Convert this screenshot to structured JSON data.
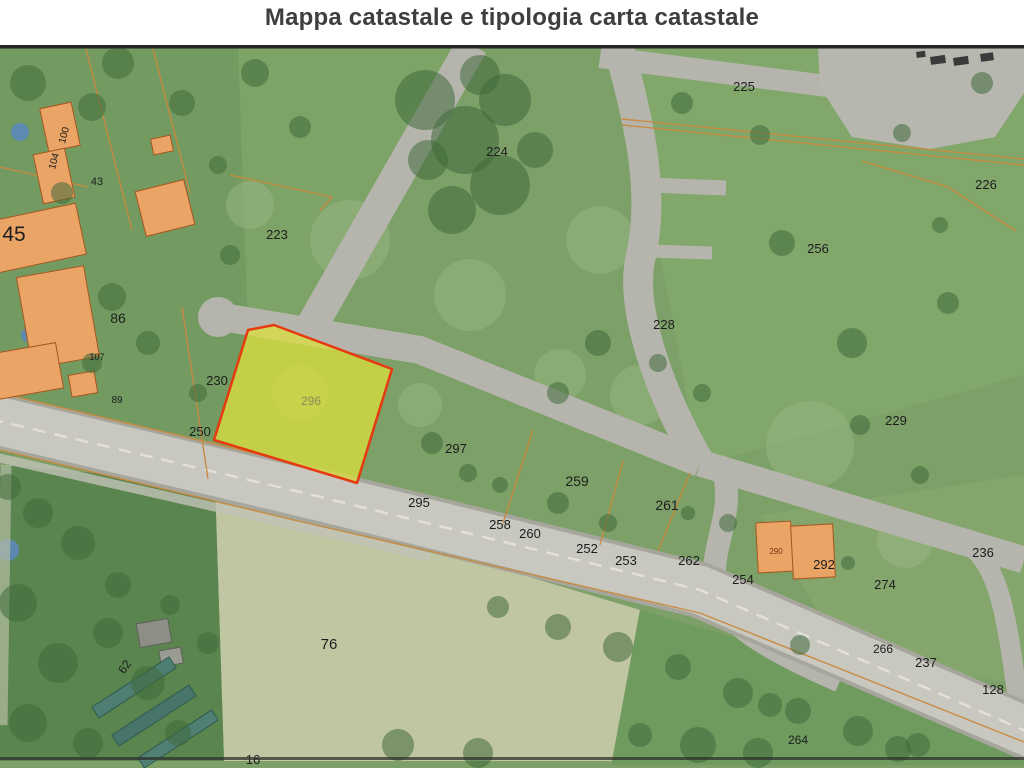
{
  "title": "Mappa catastale e tipologia carta catastale",
  "map": {
    "description": "aerial-cadastral-photo",
    "highlight": {
      "parcel_number": "296",
      "points": "248,285 274,280 392,324 357,438 214,395",
      "fill": "#dfe03a",
      "fill_opacity": 0.72,
      "stroke": "#e63a10",
      "stroke_width": 2.5
    },
    "colors": {
      "base": "#7ca067",
      "road": "#b5b5ad",
      "road_edge": "#a6a69c",
      "road_main": "#c8c8c0",
      "center_line": "#e2e0d8",
      "tree": "#3f693b",
      "patch": "#9db988",
      "blue": "#5c88bb",
      "boundary": "#c8893d",
      "building_fill": "#e9a466",
      "building_stroke": "#a8561e",
      "plaza": "#b7b7af",
      "car": "#3a3a3a",
      "label": "#1d1d1d",
      "border": "#252525"
    },
    "regions": [
      {
        "p": "0,0 238,0 248,285 214,395 0,412",
        "f": "#739b61",
        "o": 1
      },
      {
        "p": "238,0 472,0 310,284 248,285",
        "f": "#7ea468",
        "o": 0.7
      },
      {
        "p": "620,0 1024,0 1024,330 700,420",
        "f": "#82a76b",
        "o": 0.9
      },
      {
        "p": "760,470 1024,430 1024,640 845,612",
        "f": "#8cab74",
        "o": 0.5
      },
      {
        "p": "215,438 640,565 612,716 224,716",
        "f": "#c0c5a2",
        "o": 1
      },
      {
        "p": "0,420 215,438 224,716 0,716",
        "f": "#5a854e",
        "o": 1
      },
      {
        "p": "612,716 640,565 900,640 1024,690 1024,720 612,720",
        "f": "#6f9b5f",
        "o": 1
      }
    ],
    "patches": [
      [
        350,
        195,
        40
      ],
      [
        600,
        195,
        34
      ],
      [
        810,
        400,
        44
      ],
      [
        300,
        348,
        28
      ],
      [
        640,
        350,
        30
      ],
      [
        905,
        495,
        28
      ],
      [
        470,
        250,
        36
      ],
      [
        250,
        160,
        24
      ],
      [
        560,
        330,
        26
      ],
      [
        420,
        360,
        22
      ]
    ],
    "plaza": {
      "p": "818,0 1024,0 1024,48 995,92 930,104 852,92 820,42"
    },
    "culdesac": {
      "cx": 218,
      "cy": 272,
      "r": 20
    },
    "roads": [
      {
        "d": "M 600,12 L 835,42",
        "w": 22
      },
      {
        "d": "M 618,0 C 640,80 656,150 640,215 C 630,268 662,352 700,418",
        "w": 30
      },
      {
        "d": "M 648,140 L 726,143",
        "w": 15
      },
      {
        "d": "M 650,206 L 712,208",
        "w": 13
      },
      {
        "d": "M 472,0 L 310,284",
        "w": 32
      },
      {
        "d": "M 222,272 L 420,305 L 700,418",
        "w": 28
      },
      {
        "d": "M 700,418 L 1024,515",
        "w": 27
      },
      {
        "d": "M 968,498 C 1000,524 1006,568 1018,655",
        "w": 20
      },
      {
        "d": "M 722,420 C 737,468 710,498 715,540 C 720,576 762,602 840,636",
        "w": 23
      },
      {
        "d": "M -5,412 L 250,470 L 430,512",
        "w": 9,
        "c": "#c2c2b8",
        "o": 0.8
      },
      {
        "d": "M 6,420 L 2,680",
        "w": 11,
        "c": "#b5bda5",
        "o": 0.7
      },
      {
        "d": "M -10,374 L 300,447 L 700,545 L 1035,690",
        "w": 56,
        "c": "#a6a69c"
      },
      {
        "d": "M -10,374 L 300,447 L 700,545 L 1035,690",
        "w": 48,
        "c": "#c8c8c0"
      },
      {
        "d": "M -10,374 L 300,447 L 700,545 L 1035,690",
        "w": 2.5,
        "c": "#e2e0d8",
        "dash": "13 9"
      }
    ],
    "boundaries": [
      "M 622,74 L 1024,114",
      "M 622,80 L 1024,120",
      "M 862,116 L 948,142 L 1016,186",
      "M 230,130 L 332,152 L 320,166",
      "M 533,385 L 503,478",
      "M 623,416 L 600,500",
      "M 690,428 L 658,506",
      "M 182,262 L 208,434",
      "M 85,0 L 132,185",
      "M 152,0 L 190,148",
      "M 0,122 L 88,142",
      "M 0,348 L 295,418",
      "M 0,405 L 298,476 L 700,568 L 1024,697"
    ],
    "buildings": [
      [
        -18,
        168,
        100,
        52,
        -12
      ],
      [
        24,
        226,
        68,
        92,
        -10
      ],
      [
        -6,
        303,
        66,
        46,
        -10
      ],
      [
        70,
        328,
        26,
        22,
        -10
      ],
      [
        44,
        60,
        32,
        44,
        -12
      ],
      [
        38,
        106,
        32,
        50,
        -12
      ],
      [
        140,
        140,
        50,
        46,
        -14
      ],
      [
        152,
        92,
        20,
        16,
        -12
      ],
      [
        757,
        477,
        35,
        50,
        -3
      ],
      [
        792,
        480,
        42,
        53,
        -3
      ],
      [
        138,
        576,
        32,
        24,
        -10,
        "#8d8e86",
        "#5e5f58"
      ],
      [
        160,
        604,
        22,
        16,
        -10,
        "#9a9b93",
        "#5e5f58"
      ],
      [
        88,
        636,
        92,
        13,
        -33,
        "#4e7e72",
        "#2f5a50"
      ],
      [
        108,
        664,
        92,
        13,
        -33,
        "#47756a",
        "#2f5a50"
      ],
      [
        134,
        688,
        88,
        12,
        -33,
        "#508074",
        "#2f5a50"
      ]
    ],
    "blue": [
      [
        20,
        87,
        9
      ],
      [
        28,
        290,
        7
      ],
      [
        8,
        505,
        11
      ]
    ],
    "cars": [
      [
        930,
        12,
        15,
        8
      ],
      [
        953,
        13,
        15,
        8
      ],
      [
        980,
        9,
        13,
        8
      ],
      [
        916,
        7,
        9,
        6
      ]
    ],
    "trees": [
      [
        425,
        55,
        30
      ],
      [
        465,
        95,
        34
      ],
      [
        505,
        55,
        26
      ],
      [
        500,
        140,
        30
      ],
      [
        452,
        165,
        24
      ],
      [
        428,
        115,
        20
      ],
      [
        535,
        105,
        18
      ],
      [
        480,
        30,
        20
      ],
      [
        255,
        28,
        14
      ],
      [
        300,
        82,
        11
      ],
      [
        118,
        18,
        16
      ],
      [
        182,
        58,
        13
      ],
      [
        92,
        62,
        14
      ],
      [
        28,
        38,
        18
      ],
      [
        62,
        148,
        11
      ],
      [
        218,
        120,
        9
      ],
      [
        112,
        252,
        14
      ],
      [
        148,
        298,
        12
      ],
      [
        92,
        318,
        10
      ],
      [
        198,
        348,
        9
      ],
      [
        230,
        210,
        10
      ],
      [
        682,
        58,
        11
      ],
      [
        782,
        198,
        13
      ],
      [
        852,
        298,
        15
      ],
      [
        948,
        258,
        11
      ],
      [
        702,
        348,
        9
      ],
      [
        902,
        88,
        9
      ],
      [
        982,
        38,
        11
      ],
      [
        760,
        90,
        10
      ],
      [
        940,
        180,
        8
      ],
      [
        598,
        298,
        13
      ],
      [
        558,
        348,
        11
      ],
      [
        658,
        318,
        9
      ],
      [
        860,
        380,
        10
      ],
      [
        920,
        430,
        9
      ],
      [
        432,
        398,
        11
      ],
      [
        468,
        428,
        9
      ],
      [
        558,
        458,
        11
      ],
      [
        608,
        478,
        9
      ],
      [
        688,
        468,
        7
      ],
      [
        500,
        440,
        8
      ],
      [
        8,
        442,
        13
      ],
      [
        38,
        468,
        15
      ],
      [
        78,
        498,
        17
      ],
      [
        18,
        558,
        19
      ],
      [
        58,
        618,
        20
      ],
      [
        108,
        588,
        15
      ],
      [
        148,
        638,
        17
      ],
      [
        28,
        678,
        19
      ],
      [
        88,
        698,
        15
      ],
      [
        178,
        688,
        13
      ],
      [
        208,
        598,
        11
      ],
      [
        118,
        540,
        13
      ],
      [
        170,
        560,
        10
      ],
      [
        558,
        582,
        13
      ],
      [
        618,
        602,
        15
      ],
      [
        678,
        622,
        13
      ],
      [
        738,
        648,
        15
      ],
      [
        798,
        666,
        13
      ],
      [
        858,
        686,
        15
      ],
      [
        498,
        562,
        11
      ],
      [
        918,
        700,
        12
      ],
      [
        398,
        700,
        16
      ],
      [
        478,
        708,
        15
      ],
      [
        698,
        700,
        18
      ],
      [
        758,
        708,
        15
      ],
      [
        898,
        704,
        13
      ],
      [
        640,
        690,
        12
      ],
      [
        728,
        478,
        9
      ],
      [
        848,
        518,
        7
      ],
      [
        800,
        600,
        10
      ],
      [
        770,
        660,
        12
      ]
    ],
    "parcel_labels": [
      {
        "t": "100",
        "x": 67,
        "y": 91,
        "s": 10,
        "r": -75
      },
      {
        "t": "104",
        "x": 57,
        "y": 117,
        "s": 10,
        "r": -75
      },
      {
        "t": "43",
        "x": 97,
        "y": 140,
        "s": 11
      },
      {
        "t": "45",
        "x": 14,
        "y": 196,
        "s": 21
      },
      {
        "t": "86",
        "x": 118,
        "y": 278,
        "s": 14
      },
      {
        "t": "107",
        "x": 97,
        "y": 315,
        "s": 9
      },
      {
        "t": "89",
        "x": 117,
        "y": 358,
        "s": 10
      },
      {
        "t": "230",
        "x": 217,
        "y": 340,
        "s": 13
      },
      {
        "t": "250",
        "x": 200,
        "y": 391,
        "s": 13
      },
      {
        "t": "296",
        "x": 311,
        "y": 360,
        "s": 12,
        "c": "#8c8d58"
      },
      {
        "t": "223",
        "x": 277,
        "y": 194,
        "s": 13
      },
      {
        "t": "224",
        "x": 497,
        "y": 111,
        "s": 13
      },
      {
        "t": "225",
        "x": 744,
        "y": 46,
        "s": 13
      },
      {
        "t": "226",
        "x": 986,
        "y": 144,
        "s": 13
      },
      {
        "t": "256",
        "x": 818,
        "y": 208,
        "s": 13
      },
      {
        "t": "228",
        "x": 664,
        "y": 284,
        "s": 13
      },
      {
        "t": "229",
        "x": 896,
        "y": 380,
        "s": 13
      },
      {
        "t": "297",
        "x": 456,
        "y": 408,
        "s": 13
      },
      {
        "t": "295",
        "x": 419,
        "y": 462,
        "s": 13
      },
      {
        "t": "259",
        "x": 577,
        "y": 441,
        "s": 14
      },
      {
        "t": "261",
        "x": 667,
        "y": 465,
        "s": 14
      },
      {
        "t": "258",
        "x": 500,
        "y": 484,
        "s": 13
      },
      {
        "t": "260",
        "x": 530,
        "y": 493,
        "s": 13
      },
      {
        "t": "252",
        "x": 587,
        "y": 508,
        "s": 13
      },
      {
        "t": "253",
        "x": 626,
        "y": 520,
        "s": 13
      },
      {
        "t": "262",
        "x": 689,
        "y": 520,
        "s": 13
      },
      {
        "t": "254",
        "x": 743,
        "y": 539,
        "s": 13
      },
      {
        "t": "290",
        "x": 776,
        "y": 509,
        "s": 8,
        "c": "#7a3014"
      },
      {
        "t": "292",
        "x": 824,
        "y": 524,
        "s": 13
      },
      {
        "t": "274",
        "x": 885,
        "y": 544,
        "s": 13
      },
      {
        "t": "236",
        "x": 983,
        "y": 512,
        "s": 13
      },
      {
        "t": "266",
        "x": 883,
        "y": 608,
        "s": 12
      },
      {
        "t": "237",
        "x": 926,
        "y": 622,
        "s": 13
      },
      {
        "t": "128",
        "x": 993,
        "y": 649,
        "s": 13
      },
      {
        "t": "264",
        "x": 798,
        "y": 699,
        "s": 12
      },
      {
        "t": "76",
        "x": 329,
        "y": 604,
        "s": 15
      },
      {
        "t": "62",
        "x": 128,
        "y": 624,
        "s": 12,
        "r": -55
      },
      {
        "t": "16",
        "x": 253,
        "y": 719,
        "s": 13
      }
    ]
  }
}
